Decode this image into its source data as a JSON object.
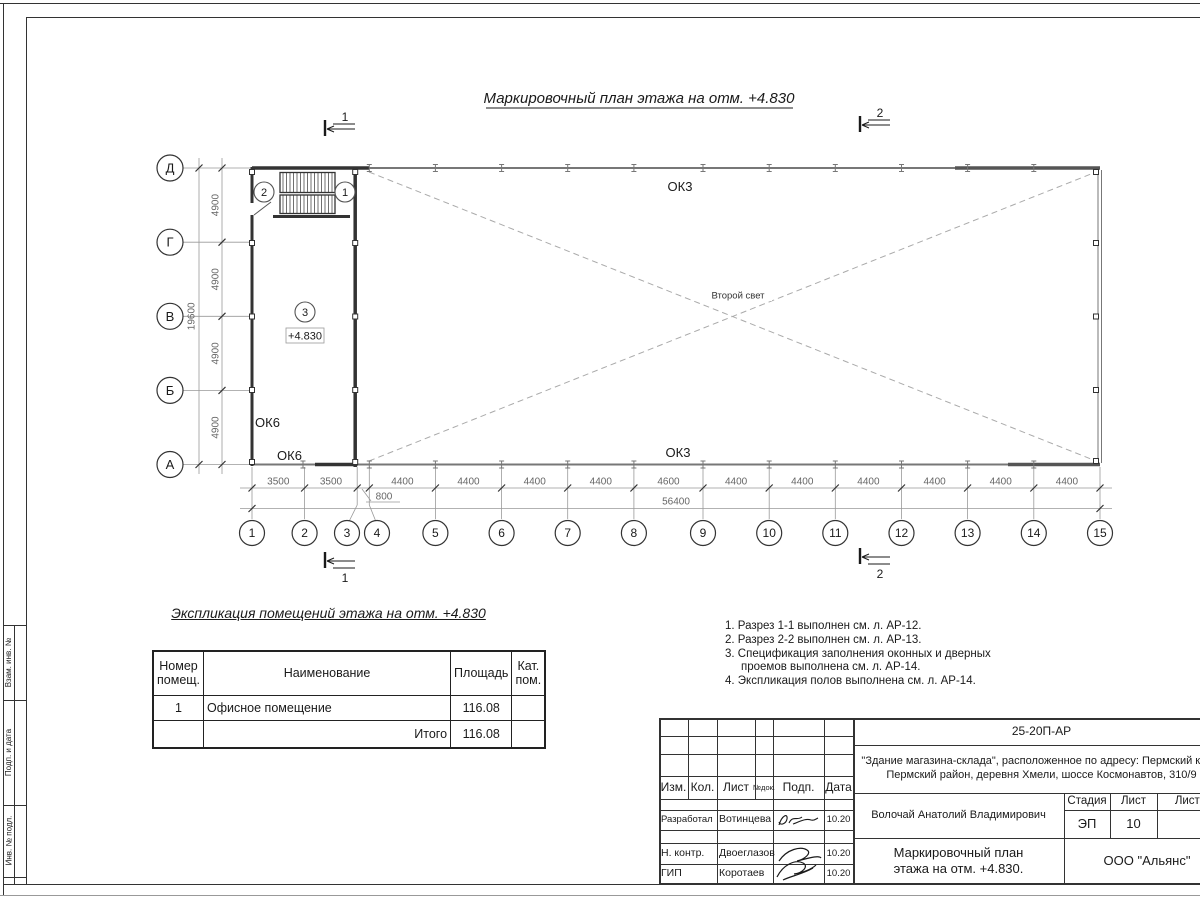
{
  "sheet": {
    "drawing_title": "Маркировочный план этажа на отм. +4.830",
    "side_labels": [
      "Взам. инв. №",
      "Подп. и дата",
      "Инв. № подл."
    ]
  },
  "plan": {
    "row_axes": [
      "Д",
      "Г",
      "В",
      "Б",
      "А"
    ],
    "row_dims": [
      "4900",
      "4900",
      "4900",
      "4900"
    ],
    "row_total": "19600",
    "col_axes": [
      "1",
      "2",
      "3",
      "4",
      "5",
      "6",
      "7",
      "8",
      "9",
      "10",
      "11",
      "12",
      "13",
      "14",
      "15"
    ],
    "col_dims": [
      "3500",
      "3500",
      "4400",
      "4400",
      "4400",
      "4400",
      "4600",
      "4400",
      "4400",
      "4400",
      "4400",
      "4400",
      "4400"
    ],
    "offset_dim": "800",
    "col_total": "56400",
    "labels": {
      "ok3_top": "ОК3",
      "ok3_bottom": "ОК3",
      "ok6_left": "ОК6",
      "ok6_bottom": "ОК6",
      "second_light": "Второй свет",
      "level_mark": "+4.830"
    },
    "rooms": {
      "r1": "1",
      "r2": "2",
      "r3": "3"
    },
    "sections": {
      "s1": "1",
      "s2": "2"
    }
  },
  "explication": {
    "title": "Экспликация помещений этажа на отм. +4.830",
    "col_number": "Номер помещ.",
    "col_name": "Наименование",
    "col_area": "Площадь",
    "col_cat": "Кат. пом.",
    "row1": {
      "number": "1",
      "name": "Офисное помещение",
      "area": "116.08",
      "cat": ""
    },
    "total_label": "Итого",
    "total_area": "116.08"
  },
  "notes": {
    "items": [
      "1. Разрез 1-1 выполнен см. л. АР-12.",
      "2. Разрез 2-2 выполнен см. л. АР-13.",
      "3. Спецификация заполнения оконных и дверных проемов выполнена см. л. АР-14.",
      "4. Экспликация полов выполнена см. л. АР-14."
    ]
  },
  "titleblock": {
    "doc_number": "25-20П-АР",
    "project_line1": "\"Здание магазина-склада\", расположенное по адресу: Пермский край,",
    "project_line2": "Пермский район, деревня Хмели, шоссе Космонавтов, 310/9",
    "header_cols": {
      "izm": "Изм.",
      "kol": "Кол.",
      "list": "Лист",
      "ndoc": "№док.",
      "podp": "Подп.",
      "data": "Дата"
    },
    "rows": [
      {
        "role": "Разработал",
        "name": "Вотинцева",
        "date": "10.20"
      },
      {
        "role": "Н. контр.",
        "name": "Двоеглазов",
        "date": "10.20"
      },
      {
        "role": "ГИП",
        "name": "Коротаев",
        "date": "10.20"
      }
    ],
    "approver": "Волочай Анатолий Владимирович",
    "stage_label": "Стадия",
    "sheet_label": "Лист",
    "sheets_label": "Листов",
    "stage": "ЭП",
    "sheet_num": "10",
    "sheets_total": "",
    "doc_title_line1": "Маркировочный план",
    "doc_title_line2": "этажа на отм. +4.830.",
    "company": "ООО \"Альянс\""
  }
}
